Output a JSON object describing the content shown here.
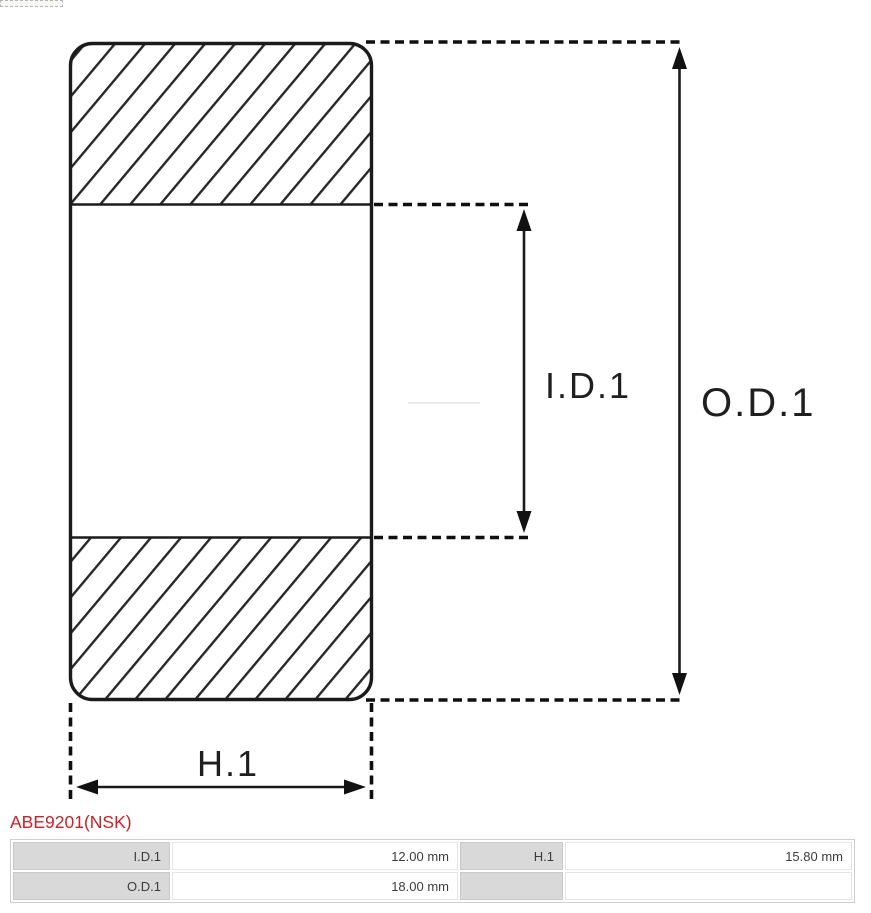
{
  "diagram": {
    "labels": {
      "id1": "I.D.1",
      "od1": "O.D.1",
      "h1": "H.1"
    },
    "colors": {
      "stroke": "#1b1b1b",
      "hatch": "#262626",
      "dashed": "#0f0f0f",
      "faint_line": "#ececec"
    }
  },
  "part": {
    "title": "ABE9201(NSK)",
    "title_color": "#cb2127"
  },
  "spec_table": {
    "label_bg": "#d9d9d9",
    "rows": [
      {
        "c1_label": "I.D.1",
        "c1_value": "12.00 mm",
        "c2_label": "H.1",
        "c2_value": "15.80 mm"
      },
      {
        "c1_label": "O.D.1",
        "c1_value": "18.00 mm",
        "c2_label": "",
        "c2_value": ""
      }
    ]
  }
}
